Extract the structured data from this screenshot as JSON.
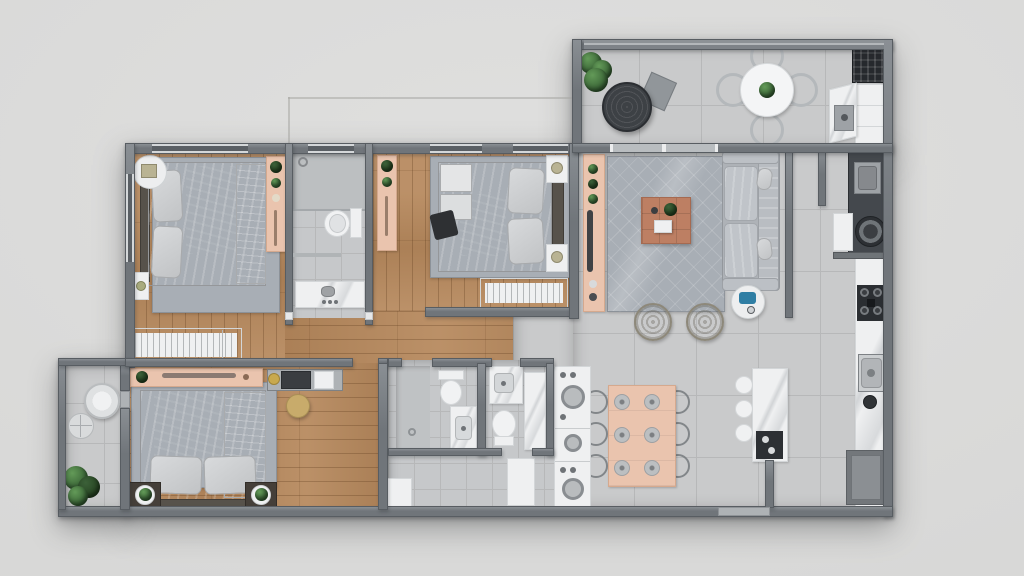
{
  "title": "apartment-floor-plan-3d-top-view",
  "palette": {
    "background": "#dfdfde",
    "wall": "#70757a",
    "wall_edge": "#585d62",
    "window_glass": "#5a5f64",
    "window_glass2": "#b9bdc0",
    "glass_rail": "#7e8388",
    "door": "#aeb2b5",
    "wood": "#b6885c",
    "tile": "#c9cacb",
    "tile_line": "#b7b8b9",
    "bath_tile": "#c6c8ca",
    "rug": "#a8aeb5",
    "pink": "#eac4ae",
    "pink_edge": "#d5a98e",
    "white": "#eff0f1",
    "counter_edge": "#d3d6d8",
    "dark_counter": "#44484d",
    "dark_fabric": "#323437",
    "terracotta": "#bd7f63",
    "headboard": "#57524b",
    "plant": "#335c31",
    "wicker": "#a8a394",
    "papasan": "#3d4145",
    "stainless": "#9ea2a6",
    "grill": "#26292d",
    "wardrobe_line": "#b4b7b9",
    "blue_accent": "#2f7ea4",
    "stool_wood": "#c8ab6b",
    "lamp": "#b9b393"
  },
  "rooms": [
    {
      "id": "terrace",
      "furniture": [
        "plant-pot",
        "papasan-chair",
        "cushion",
        "round-dining-table",
        "four-wire-chairs",
        "barbecue-grill",
        "corner-counter",
        "sink"
      ]
    },
    {
      "id": "living-room",
      "furniture": [
        "tv-sideboard",
        "area-rug",
        "coffee-table",
        "sofa",
        "round-side-table",
        "wicker-armchair",
        "wicker-armchair"
      ]
    },
    {
      "id": "bedroom-1",
      "furniture": [
        "double-bed",
        "round-nightstand-lamp",
        "speaker",
        "desk-shelf",
        "wardrobe",
        "rug"
      ]
    },
    {
      "id": "bathroom-top",
      "furniture": [
        "shower",
        "toilet",
        "vanity-sink"
      ]
    },
    {
      "id": "bedroom-2",
      "furniture": [
        "double-bed",
        "nightstand",
        "nightstand",
        "desk-shelf",
        "wardrobe",
        "rug"
      ]
    },
    {
      "id": "master-bedroom",
      "furniture": [
        "double-bed",
        "planter-nightstand",
        "planter-nightstand",
        "pink-shelf",
        "makeup-counter",
        "stool",
        "rug",
        "wardrobe"
      ]
    },
    {
      "id": "small-balcony",
      "furniture": [
        "wicker-chair",
        "side-table",
        "plant"
      ]
    },
    {
      "id": "bathroom-a",
      "furniture": [
        "toilet",
        "vanity-sink",
        "shower-area"
      ]
    },
    {
      "id": "bathroom-b",
      "furniture": [
        "vanity-sink",
        "marble-panel",
        "toilet"
      ]
    },
    {
      "id": "kitchen-dining",
      "furniture": [
        "dining-table",
        "six-chairs",
        "six-place-settings",
        "island-counter",
        "bar-stools",
        "island-cooktop",
        "oven-tower",
        "wall-counter",
        "cooktop",
        "sink",
        "refrigerator",
        "cabinet"
      ]
    },
    {
      "id": "service-area",
      "furniture": [
        "dark-counter",
        "sink",
        "washing-machine"
      ]
    }
  ]
}
